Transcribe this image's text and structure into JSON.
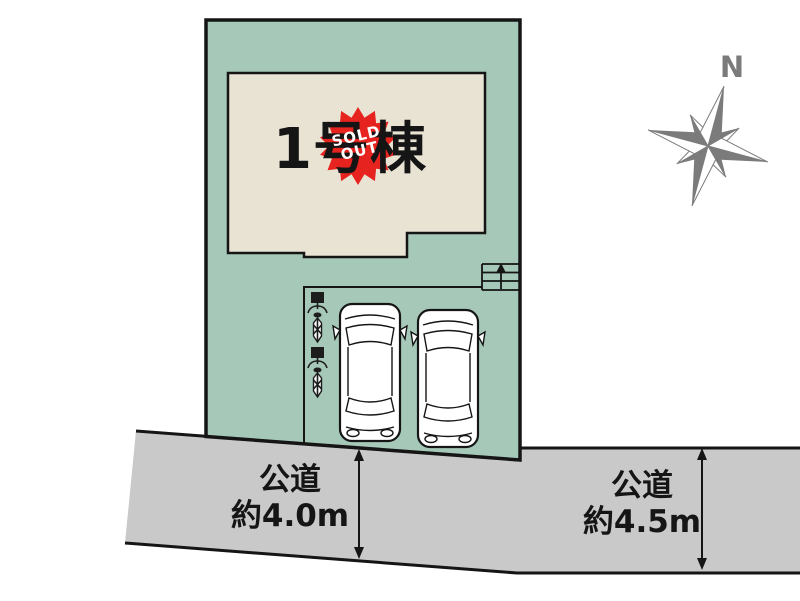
{
  "colors": {
    "plot-green": "#a6c8b8",
    "building-beige": "#e9e3d4",
    "road-gray": "#c9c9c9",
    "line-black": "#151515",
    "compass-gray": "#7b7b7b",
    "sold-red": "#e6231e",
    "paper-white": "#ffffff"
  },
  "site_plan": {
    "building": {
      "label": "1号棟"
    },
    "sold_out_badge": {
      "line1": "SOLD",
      "line2": "OUT"
    },
    "compass": {
      "north_label": "N"
    },
    "road_bottom_left": {
      "name": "公道",
      "width": "約4.0m"
    },
    "road_bottom_right": {
      "name": "公道",
      "width": "約4.5m"
    },
    "parking": {
      "car_count": 2,
      "bicycle_count": 2
    },
    "icons": {
      "compass-rose-icon": "8-point gray compass star",
      "car-icon": "top-view sedan outline",
      "bicycle-icon": "top-view bicycle",
      "stairs-icon": "entrance steps with up arrow",
      "dimension-arrow-icon": "double-headed road width arrow",
      "sold-out-badge": "red starburst"
    }
  }
}
